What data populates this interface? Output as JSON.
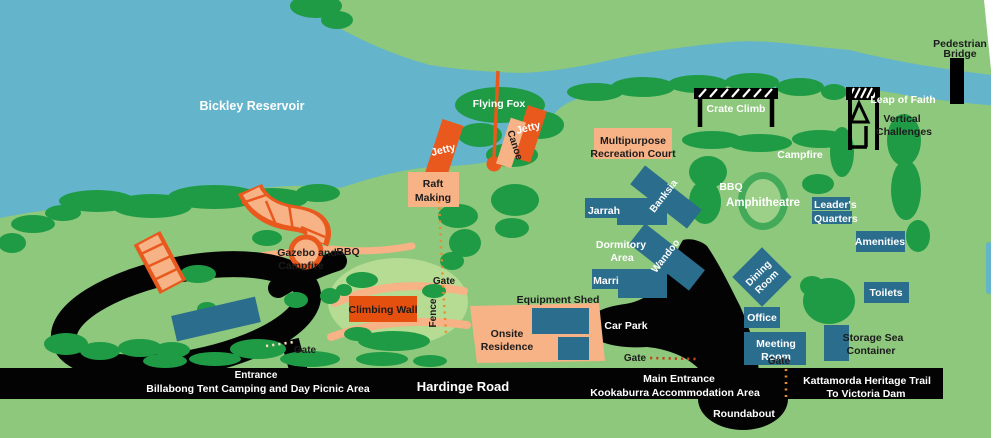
{
  "labels": {
    "reservoir": "Bickley Reservoir",
    "flying_fox": "Flying Fox",
    "jetty_west": "Jetty",
    "canoe": "Canoe",
    "jetty_east": "Jetty",
    "raft_making": [
      "Raft",
      "Making"
    ],
    "multipurpose_court": [
      "Multipurpose",
      "Recreation Court"
    ],
    "crate_climb": "Crate Climb",
    "leap_of_faith": "Leap of Faith",
    "vertical_challenges": [
      "Vertical",
      "Challenges"
    ],
    "pedestrian_bridge": [
      "Pedestrian",
      "Bridge"
    ],
    "campfire": "Campfire",
    "bbq_east": "BBQ",
    "amphitheatre": "Amphitheatre",
    "leaders_quarters": [
      "Leader's",
      "Quarters"
    ],
    "amenities_east": "Amenities",
    "toilets": "Toilets",
    "storage_sea_container": [
      "Storage Sea",
      "Container"
    ],
    "jarrah": "Jarrah",
    "banksia": "Banksia",
    "dormitory_area": [
      "Dormitory",
      "Area"
    ],
    "wandoo": "Wandoo",
    "marri": "Marri",
    "dining_room": [
      "Dining",
      "Room"
    ],
    "office": "Office",
    "meeting_room": [
      "Meeting",
      "Room"
    ],
    "equipment_shed": "Equipment Shed",
    "onsite_residence": [
      "Onsite",
      "Residence"
    ],
    "car_park": "Car Park",
    "gate_north": "Gate",
    "fence": "Fence",
    "gate_main": "Gate",
    "gate_east": "Gate",
    "gate_west": "Gate",
    "climbing_wall": "Climbing Wall",
    "gazebo_campfire": [
      "Gazebo and",
      "Campfire"
    ],
    "bbq_west": "BBQ",
    "west_entrance": [
      "Entrance",
      "Billabong Tent Camping and Day Picnic Area"
    ],
    "hardinge_road": "Hardinge Road",
    "main_entrance": [
      "Main Entrance",
      "Kookaburra Accommodation Area"
    ],
    "kattamorda_trail": [
      "Kattamorda Heritage Trail",
      "To Victoria Dam"
    ],
    "roundabout": "Roundabout"
  },
  "colors": {
    "water": "#64b4cb",
    "land": "#8dc87c",
    "tree": "#1f9b45",
    "road": "#030303",
    "orange": "#e9591d",
    "salmon": "#f7b286",
    "teal": "#2b6d8d",
    "wall_orange": "#e6500e",
    "clearing": "#b6db93",
    "amphitheatre_ring": "#42aa58",
    "amphitheatre_inner": "#9cd089",
    "dot_orange": "#e98a2b",
    "dot_red": "#c2451a",
    "dot_cream": "#f5dcc0",
    "label_dark": "#1c1c1c",
    "label_light": "#ffffff",
    "map_edge": "#ffffff"
  }
}
